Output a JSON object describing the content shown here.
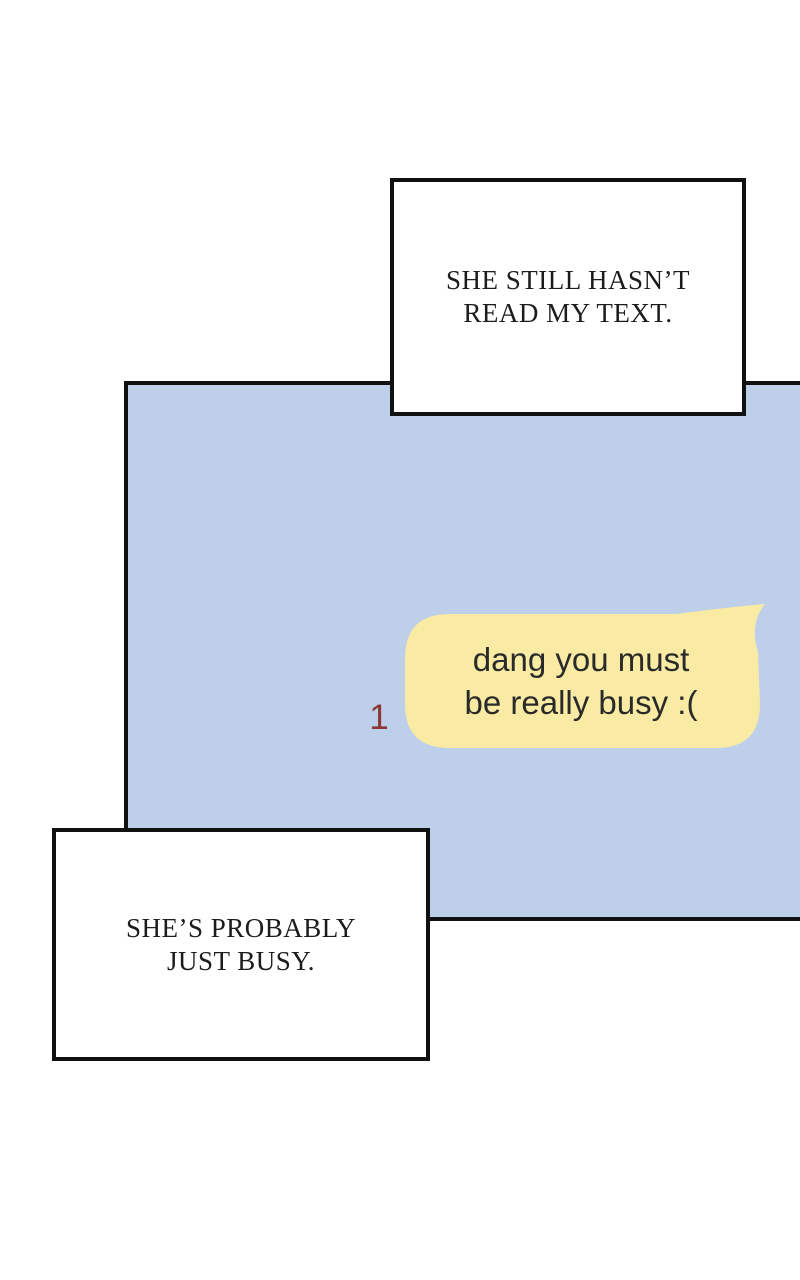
{
  "page": {
    "background_color": "#ffffff",
    "border_color": "#111111"
  },
  "narration_boxes": [
    {
      "position": "top-right",
      "lines": [
        "SHE STILL HASN’T",
        "READ MY TEXT."
      ]
    },
    {
      "position": "bottom-left",
      "lines": [
        "SHE’S PROBABLY",
        "JUST BUSY."
      ]
    }
  ],
  "chat": {
    "panel_color": "#bdcfe9",
    "bubble": {
      "color": "#f9eba3",
      "text_color": "#2a2a2a",
      "lines": [
        "dang you must",
        "be really busy :("
      ],
      "unread_count": "1",
      "unread_color": "#8d3836"
    }
  }
}
